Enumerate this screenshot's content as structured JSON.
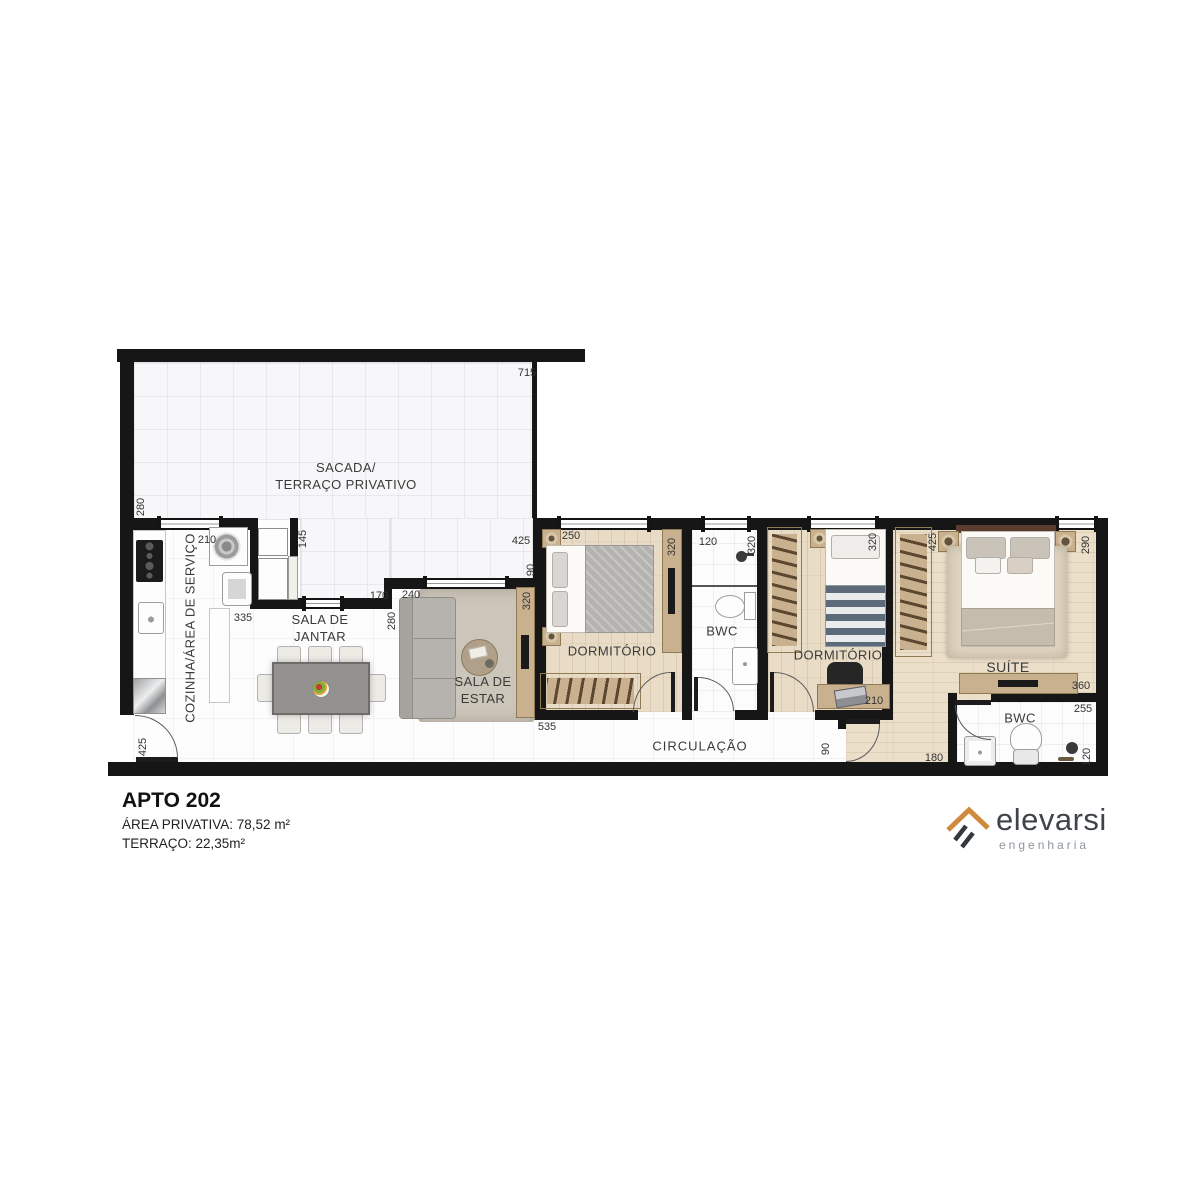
{
  "plan": {
    "rooms": {
      "sacada1": "SACADA/",
      "sacada2": "TERRAÇO PRIVATIVO",
      "cozinha": "COZINHA/ÁREA DE SERVIÇO",
      "jantar1": "SALA DE",
      "jantar2": "JANTAR",
      "estar1": "SALA DE",
      "estar2": "ESTAR",
      "dormitorio1": "DORMITÓRIO",
      "bwc1": "BWC",
      "dormitorio2": "DORMITÓRIO",
      "suite": "SUÍTE",
      "bwc2": "BWC",
      "circulacao": "CIRCULAÇÃO"
    },
    "dims": [
      "715",
      "280",
      "210",
      "145",
      "335",
      "170",
      "240",
      "280",
      "320",
      "425",
      "90",
      "250",
      "320",
      "120",
      "320",
      "320",
      "425",
      "290",
      "210",
      "360",
      "255",
      "120",
      "180",
      "90",
      "535",
      "425"
    ]
  },
  "footer": {
    "title": "APTO 202",
    "area": "ÁREA PRIVATIVA: 78,52 m²",
    "terrace": "TERRAÇO: 22,35m²"
  },
  "logo": {
    "name": "elevarsi",
    "subtitle": "engenharia"
  },
  "colors": {
    "accent_orange": "#cf8a3e",
    "wall": "#161616",
    "wood": "#e9dcc6",
    "furniture_tan": "#c9b190"
  }
}
